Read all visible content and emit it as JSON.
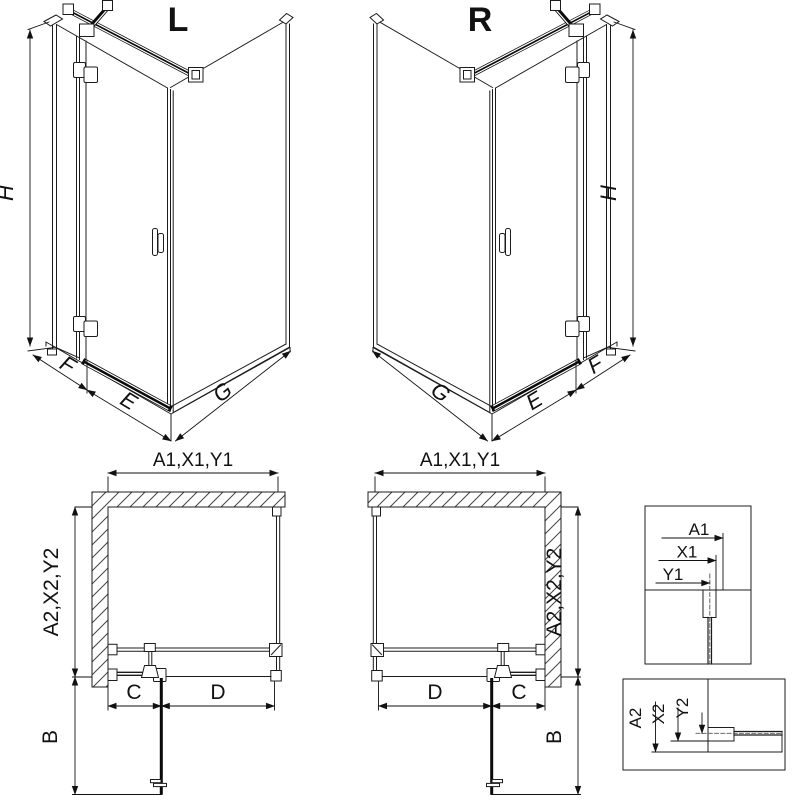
{
  "iso_left": {
    "title": "L",
    "dim_height": "H",
    "dim_fixed": "F",
    "dim_door": "E",
    "dim_side": "G"
  },
  "iso_right": {
    "title": "R",
    "dim_height": "H",
    "dim_fixed": "F",
    "dim_door": "E",
    "dim_side": "G"
  },
  "plan_left": {
    "dim_width": "A1,X1,Y1",
    "dim_depth": "A2,X2,Y2",
    "dim_fixed": "C",
    "dim_door": "D",
    "dim_swing": "B"
  },
  "plan_right": {
    "dim_width": "A1,X1,Y1",
    "dim_depth": "A2,X2,Y2",
    "dim_fixed": "C",
    "dim_door": "D",
    "dim_swing": "B"
  },
  "detail_width": {
    "dim_a": "A1",
    "dim_x": "X1",
    "dim_y": "Y1"
  },
  "detail_depth": {
    "dim_a": "A2",
    "dim_x": "X2",
    "dim_y": "Y2"
  },
  "colors": {
    "line": "#1c1c1c",
    "background": "#ffffff",
    "glass_bar": "#0a0a0a"
  }
}
